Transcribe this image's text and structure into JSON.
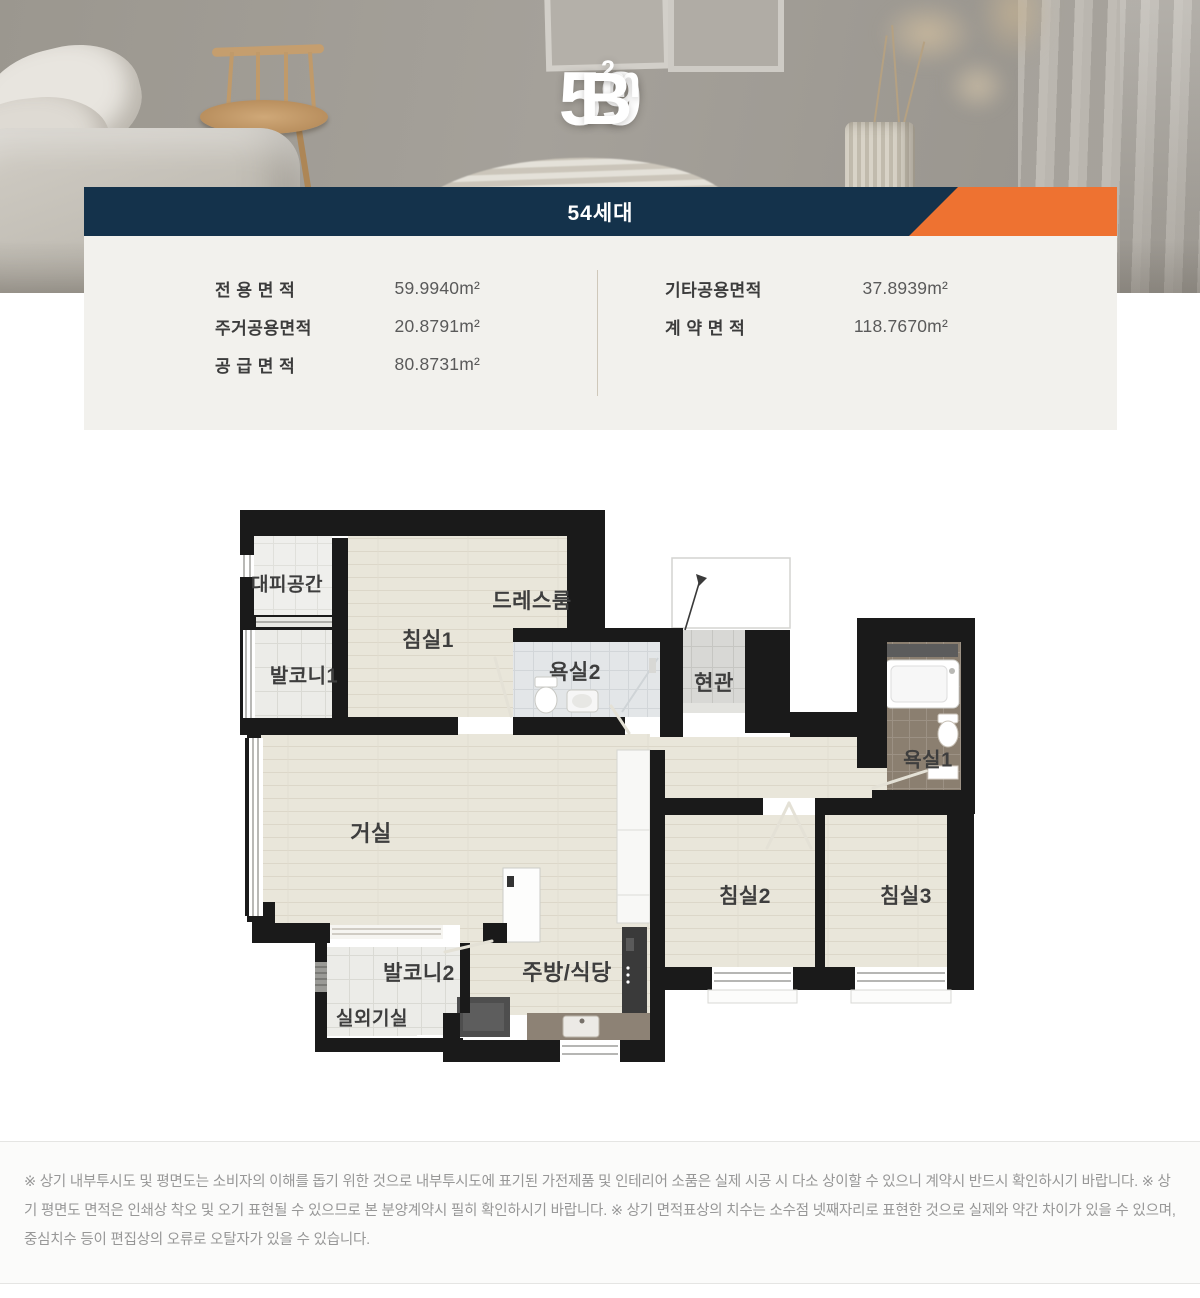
{
  "hero": {
    "title": {
      "number": "59",
      "unit": "m",
      "unit_sup": "2",
      "type": "B"
    }
  },
  "banner": {
    "label": "54세대",
    "navy": "#14324b",
    "orange": "#ee7231"
  },
  "area_table": {
    "left": [
      {
        "label": "전 용 면 적",
        "value": "59.9940m²"
      },
      {
        "label": "주거공용면적",
        "value": "20.8791m²"
      },
      {
        "label": "공 급 면 적",
        "value": "80.8731m²"
      }
    ],
    "right": [
      {
        "label": "기타공용면적",
        "value": "37.8939m²"
      },
      {
        "label": "계 약 면 적",
        "value": "118.7670m²"
      }
    ]
  },
  "floor_plan": {
    "rooms": {
      "daepi": "대피공간",
      "balcony1": "발코니1",
      "bedroom1": "침실1",
      "dressroom": "드레스룸",
      "bath2": "욕실2",
      "entrance": "현관",
      "bath1": "욕실1",
      "living": "거실",
      "kitchen": "주방/식당",
      "balcony2": "발코니2",
      "outdoor": "실외기실",
      "bedroom2": "침실2",
      "bedroom3": "침실3"
    }
  },
  "footer": {
    "disclaimer": "※ 상기 내부투시도 및 평면도는 소비자의 이해를 돕기 위한 것으로 내부투시도에 표기된 가전제품 및 인테리어 소품은 실제 시공 시 다소 상이할 수 있으니 계약시 반드시 확인하시기 바랍니다. ※ 상기 평면도 면적은 인쇄상 착오 및 오기 표현될 수 있으므로 본 분양계약시 필히 확인하시기 바랍니다. ※ 상기 면적표상의 치수는 소수점 넷째자리로 표현한 것으로 실제와 약간 차이가 있을 수 있으며, 중심치수 등이 편집상의 오류로 오탈자가 있을 수 있습니다."
  }
}
